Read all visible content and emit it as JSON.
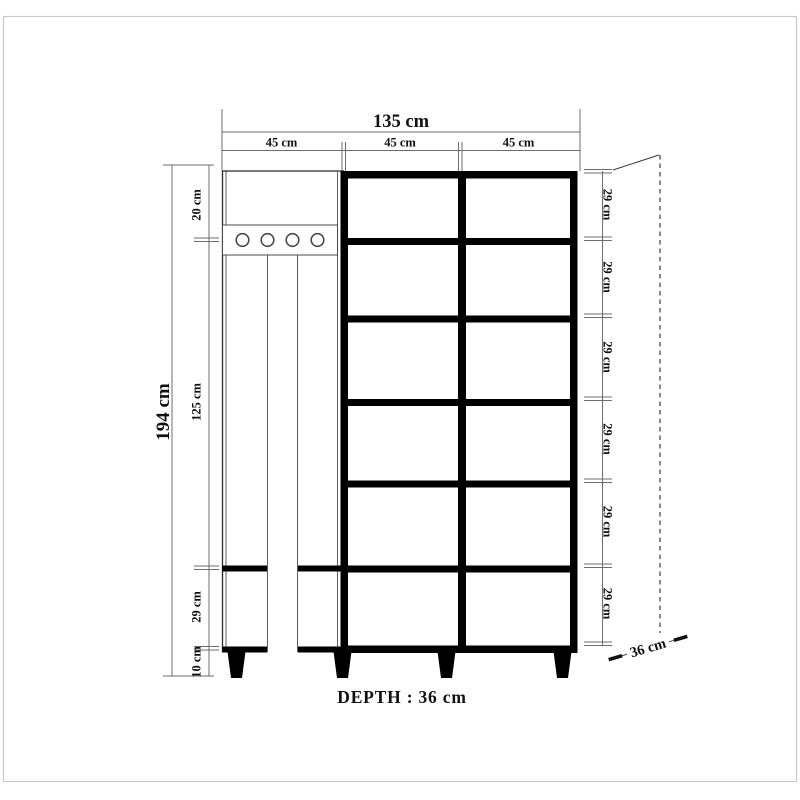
{
  "page": {
    "background": "#ffffff",
    "border_color": "#c9c9c9"
  },
  "labels": {
    "total_width": "135 cm",
    "section_widths": [
      "45 cm",
      "45 cm",
      "45 cm"
    ],
    "total_height": "194 cm",
    "left_segments": [
      "20 cm",
      "125 cm",
      "29 cm",
      "10 cm"
    ],
    "shelf_heights": [
      "29 cm",
      "29 cm",
      "29 cm",
      "29 cm",
      "29 cm",
      "29 cm"
    ],
    "depth_arrow": "36 cm",
    "depth_caption": "DEPTH : 36 cm"
  },
  "colors": {
    "furniture_line": "#000000",
    "dimension_line": "#6e6e6e",
    "label_text": "#111111"
  },
  "features": {
    "hook_count": 4,
    "shelf_rows": 6,
    "shelf_columns": 2,
    "leg_count": 4
  }
}
